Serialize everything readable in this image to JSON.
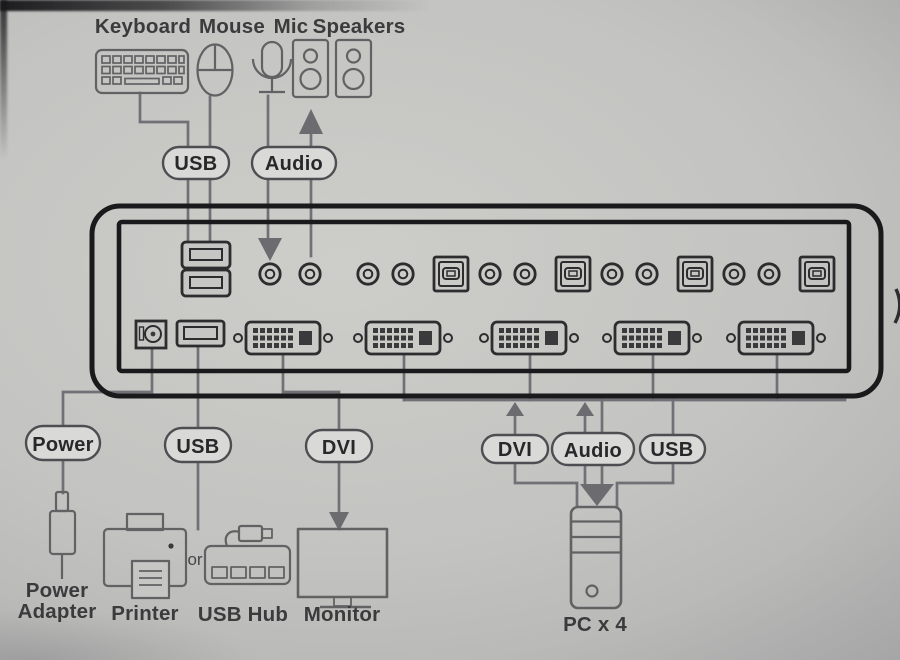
{
  "colors": {
    "background": "#c3c3c1",
    "diagram_line": "#707076",
    "device_outline": "#1a1a1c",
    "pill_fill": "#d9d9d7",
    "label_text": "#3b3b3d"
  },
  "console_devices": {
    "keyboard": "Keyboard",
    "mouse": "Mouse",
    "mic": "Mic",
    "speakers": "Speakers"
  },
  "console_cables": {
    "usb": "USB",
    "audio": "Audio"
  },
  "switch_cables": {
    "power": "Power",
    "usb": "USB",
    "dvi": "DVI"
  },
  "pc_cables": {
    "dvi": "DVI",
    "audio": "Audio",
    "usb": "USB"
  },
  "peripherals": {
    "power_adapter": [
      "Power",
      "Adapter"
    ],
    "printer": "Printer",
    "or": "or",
    "usb_hub": "USB Hub",
    "monitor": "Monitor",
    "pc": "PC x 4"
  }
}
